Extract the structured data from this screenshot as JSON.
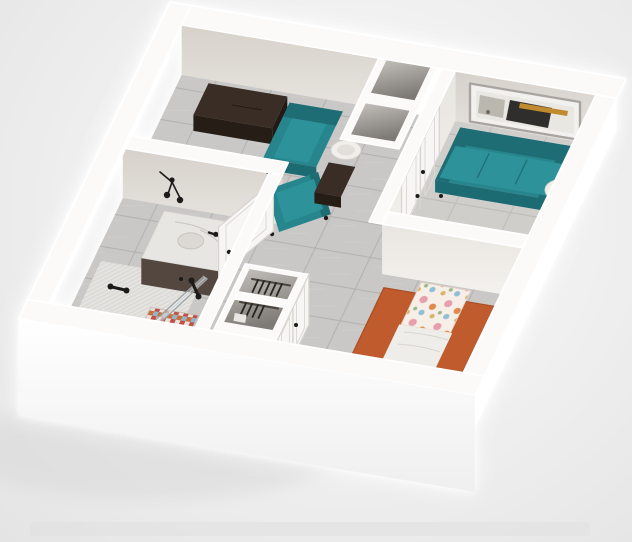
{
  "scene": {
    "title": "3D rendered one-bedroom apartment floor plan, viewed from above at an oblique angle",
    "rooms": [
      {
        "name": "entry-sitting-area",
        "position": "top-left",
        "furniture": [
          "espresso-dresser",
          "teal-accent-chair",
          "teal-chaise-chair",
          "round-side-table",
          "dark-cabinet"
        ]
      },
      {
        "name": "living-room",
        "position": "top-right",
        "furniture": [
          "teal-sofa",
          "abstract-wall-art",
          "espresso-side-table",
          "white-drum-table-lamp",
          "round-coffee-table",
          "closet-double-doors",
          "entry-door"
        ]
      },
      {
        "name": "bathroom",
        "position": "middle-left",
        "furniture": [
          "marble-top-vanity",
          "sink",
          "black-faucet",
          "black-sconce-light",
          "walk-in-shower",
          "glass-shower-panel",
          "mosaic-tile-accent",
          "shower-head",
          "shower-handle",
          "grab-bar",
          "bathroom-door"
        ]
      },
      {
        "name": "hallway",
        "position": "center",
        "furniture": [
          "closet-with-hangers-upper",
          "closet-with-hangers-lower",
          "closet-doors",
          "duct-shafts"
        ]
      },
      {
        "name": "bedroom",
        "position": "bottom-right",
        "furniture": [
          "twin-bed",
          "floral-duvet",
          "white-blanket",
          "dark-foot-bench",
          "orange-area-rug",
          "four-pane-window"
        ]
      }
    ],
    "flooring": "large gray rectangular tile",
    "view": "axonometric dollhouse cutaway, no roof"
  },
  "colors": {
    "wall": "#fbfaf9",
    "wallFaceA": "#d9d4ce",
    "wallFaceB": "#eceae6",
    "floorTile": "#c9c8c6",
    "grout": "#b4b2b0",
    "teal": "#27858d",
    "tealDark": "#1f6d74",
    "tealSeat": "#2e929a",
    "espresso": "#3a2d25",
    "espressoDark": "#261d17",
    "rug": "#bf5b2c",
    "marble": "#e8e6e2",
    "cabinet": "#544740",
    "blanket": "#efedea",
    "lamp": "#f1efec",
    "black": "#1c1b1a",
    "artGold": "#c08a2e",
    "artDark": "#2f2e2c"
  }
}
